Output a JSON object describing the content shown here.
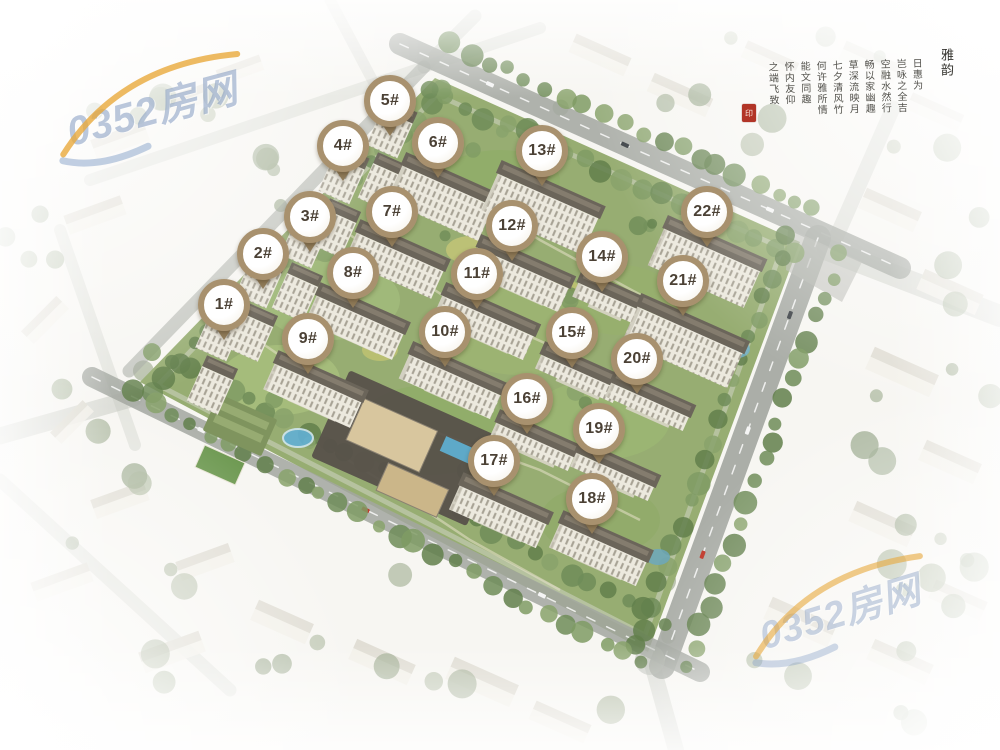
{
  "markers": [
    {
      "label": "1#",
      "x": 22.4,
      "y": 40.8
    },
    {
      "label": "2#",
      "x": 26.3,
      "y": 34.0
    },
    {
      "label": "3#",
      "x": 31.0,
      "y": 29.1
    },
    {
      "label": "4#",
      "x": 34.3,
      "y": 19.6
    },
    {
      "label": "5#",
      "x": 39.0,
      "y": 13.6
    },
    {
      "label": "6#",
      "x": 43.8,
      "y": 19.2
    },
    {
      "label": "7#",
      "x": 39.2,
      "y": 28.4
    },
    {
      "label": "8#",
      "x": 35.3,
      "y": 36.5
    },
    {
      "label": "9#",
      "x": 30.8,
      "y": 45.3
    },
    {
      "label": "10#",
      "x": 44.5,
      "y": 44.4
    },
    {
      "label": "11#",
      "x": 47.7,
      "y": 36.7
    },
    {
      "label": "12#",
      "x": 51.2,
      "y": 30.3
    },
    {
      "label": "13#",
      "x": 54.2,
      "y": 20.3
    },
    {
      "label": "14#",
      "x": 60.2,
      "y": 34.4
    },
    {
      "label": "15#",
      "x": 57.2,
      "y": 44.5
    },
    {
      "label": "16#",
      "x": 52.7,
      "y": 53.3
    },
    {
      "label": "17#",
      "x": 49.4,
      "y": 61.6
    },
    {
      "label": "18#",
      "x": 59.2,
      "y": 66.7
    },
    {
      "label": "19#",
      "x": 59.9,
      "y": 57.3
    },
    {
      "label": "20#",
      "x": 63.7,
      "y": 48.0
    },
    {
      "label": "21#",
      "x": 68.3,
      "y": 37.6
    },
    {
      "label": "22#",
      "x": 70.7,
      "y": 28.4
    }
  ],
  "watermarks": {
    "top_left": "0352房网",
    "bottom_right": "0352房网"
  },
  "calligraphy": {
    "title": "雅韵",
    "columns": [
      "日惠为",
      "岂咏之全吉",
      "空融水然行",
      "畅以家幽趣",
      "草深流映月",
      "七夕清风竹",
      "何许雅所情",
      "能文同趣",
      "怀内友仰",
      "之端飞致"
    ],
    "seal_text": "印"
  },
  "colors": {
    "pin_ring": "#a8916e",
    "pin_face": "#fcfaf4",
    "pin_text": "#4b4135",
    "watermark_blue": "#7a94bc",
    "swoosh_orange": "#e8a93c",
    "site_green": "#97ad72",
    "road_gray": "#a3a7a0",
    "roof_dark": "#6b655a",
    "facade_light": "#eceadf",
    "seal_red": "#b23527"
  }
}
